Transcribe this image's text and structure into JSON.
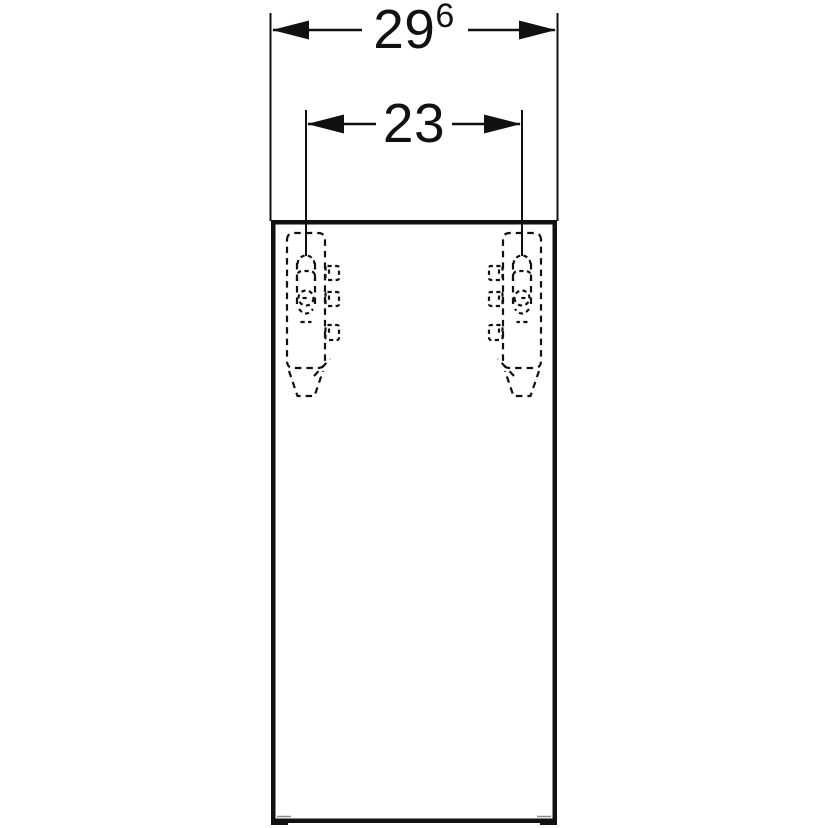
{
  "drawing": {
    "background_color": "#ffffff",
    "line_color": "#111111",
    "dimensions": {
      "overall_width": {
        "value": "29",
        "superscript": "6"
      },
      "bracket_spacing": {
        "value": "23"
      }
    }
  }
}
